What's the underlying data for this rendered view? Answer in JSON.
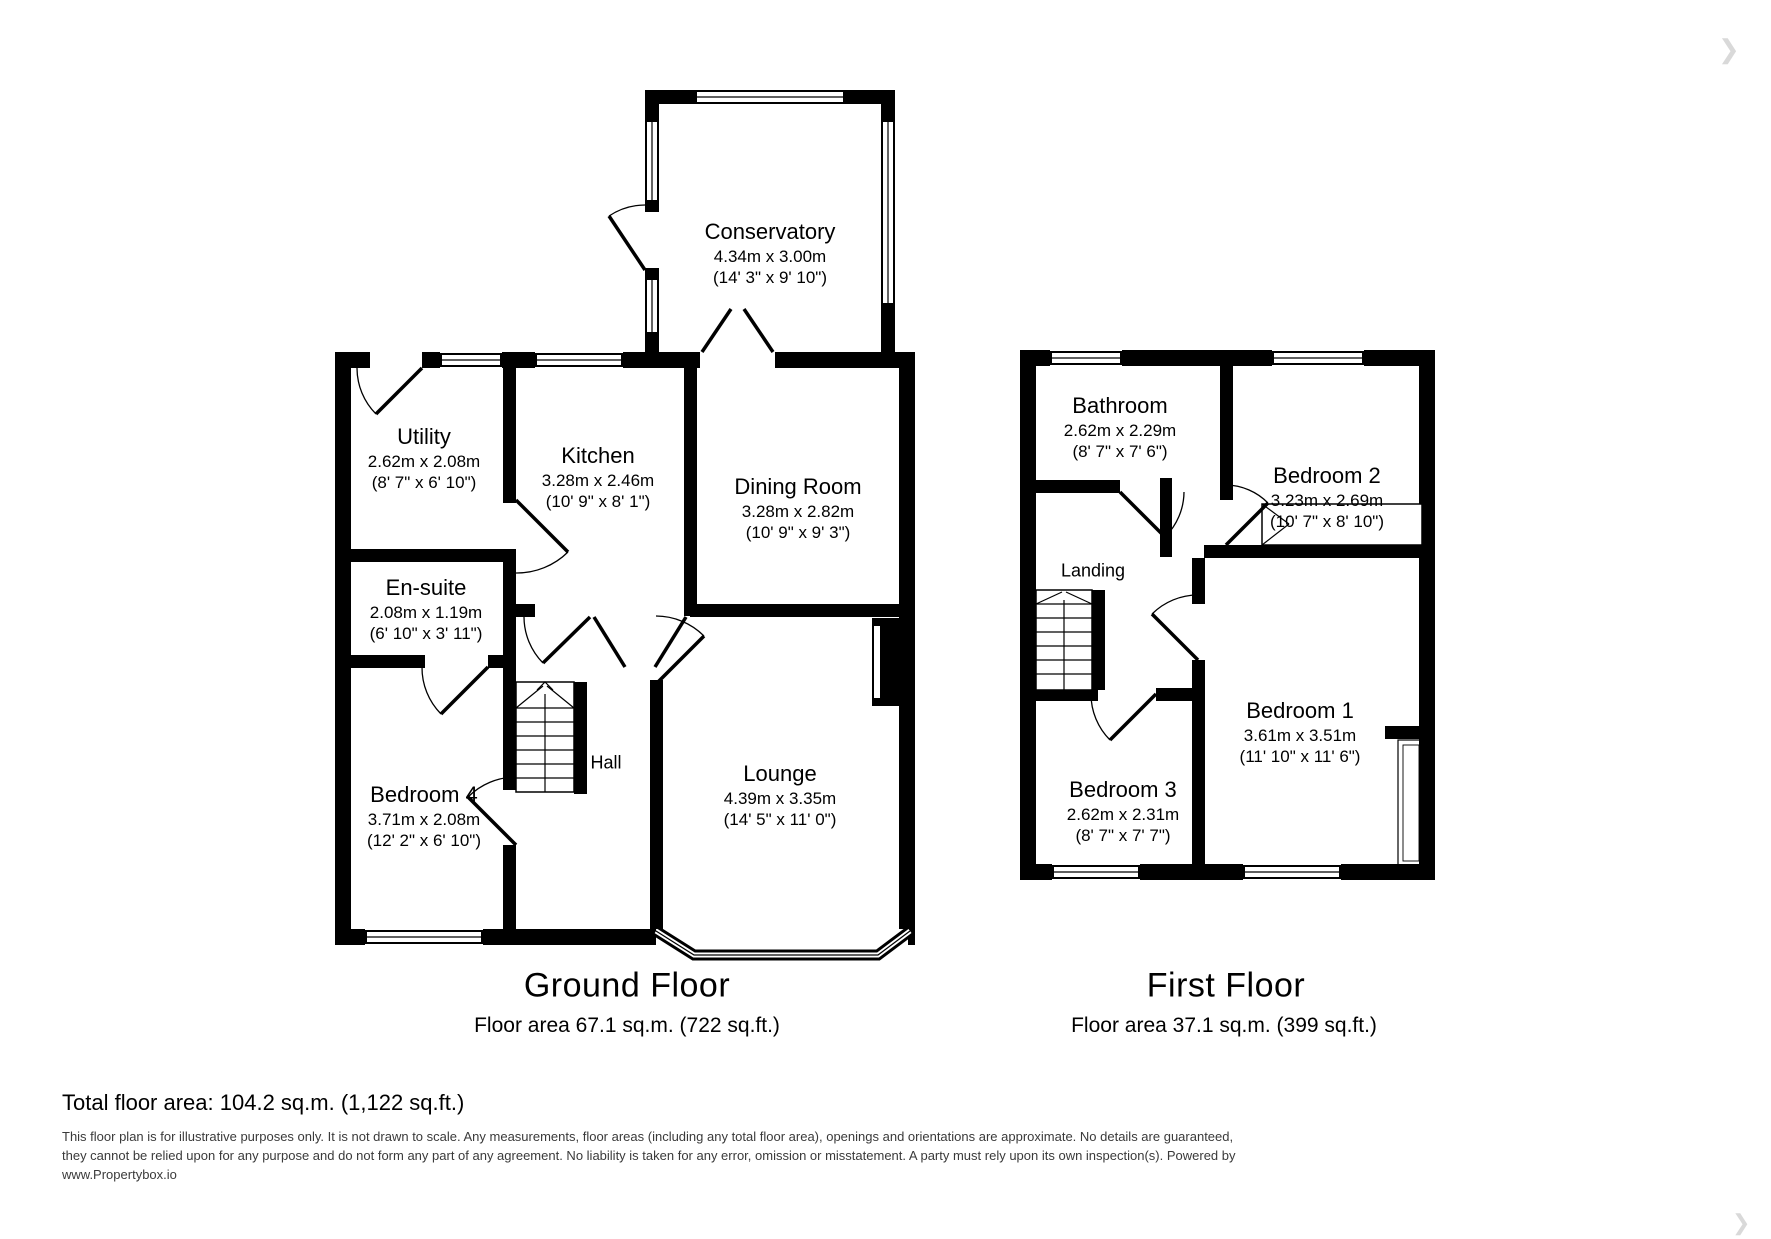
{
  "ground_floor": {
    "title": "Ground Floor",
    "area": "Floor area 67.1 sq.m. (722 sq.ft.)",
    "rooms": {
      "conservatory": {
        "name": "Conservatory",
        "metric": "4.34m x 3.00m",
        "imperial": "(14' 3\" x 9' 10\")"
      },
      "utility": {
        "name": "Utility",
        "metric": "2.62m x 2.08m",
        "imperial": "(8' 7\" x 6' 10\")"
      },
      "kitchen": {
        "name": "Kitchen",
        "metric": "3.28m x 2.46m",
        "imperial": "(10' 9\" x 8' 1\")"
      },
      "dining_room": {
        "name": "Dining Room",
        "metric": "3.28m x 2.82m",
        "imperial": "(10' 9\" x 9' 3\")"
      },
      "ensuite": {
        "name": "En-suite",
        "metric": "2.08m x 1.19m",
        "imperial": "(6' 10\" x 3' 11\")"
      },
      "bedroom4": {
        "name": "Bedroom 4",
        "metric": "3.71m x 2.08m",
        "imperial": "(12' 2\" x 6' 10\")"
      },
      "hall": {
        "name": "Hall"
      },
      "lounge": {
        "name": "Lounge",
        "metric": "4.39m x 3.35m",
        "imperial": "(14' 5\" x 11' 0\")"
      }
    }
  },
  "first_floor": {
    "title": "First Floor",
    "area": "Floor area 37.1 sq.m. (399 sq.ft.)",
    "rooms": {
      "bathroom": {
        "name": "Bathroom",
        "metric": "2.62m x 2.29m",
        "imperial": "(8' 7\" x 7' 6\")"
      },
      "bedroom2": {
        "name": "Bedroom 2",
        "metric": "3.23m x 2.69m",
        "imperial": "(10' 7\" x 8' 10\")"
      },
      "landing": {
        "name": "Landing"
      },
      "bedroom1": {
        "name": "Bedroom 1",
        "metric": "3.61m x 3.51m",
        "imperial": "(11' 10\" x 11' 6\")"
      },
      "bedroom3": {
        "name": "Bedroom 3",
        "metric": "2.62m x 2.31m",
        "imperial": "(8' 7\" x 7' 7\")"
      }
    }
  },
  "summary": {
    "total_area": "Total floor area: 104.2 sq.m. (1,122 sq.ft.)"
  },
  "disclaimer": "This floor plan is for illustrative purposes only. It is not drawn to scale. Any measurements, floor areas (including any total floor area), openings and orientations are approximate. No details are guaranteed, they cannot be relied upon for any purpose and do not form any part of any agreement. No liability is taken for any error, omission or misstatement. A party must rely upon its own inspection(s). Powered by www.Propertybox.io",
  "nav": {
    "next_arrow": "❯"
  },
  "colors": {
    "wall": "#000000",
    "background": "#ffffff",
    "muted_text": "#3a3a3a"
  }
}
